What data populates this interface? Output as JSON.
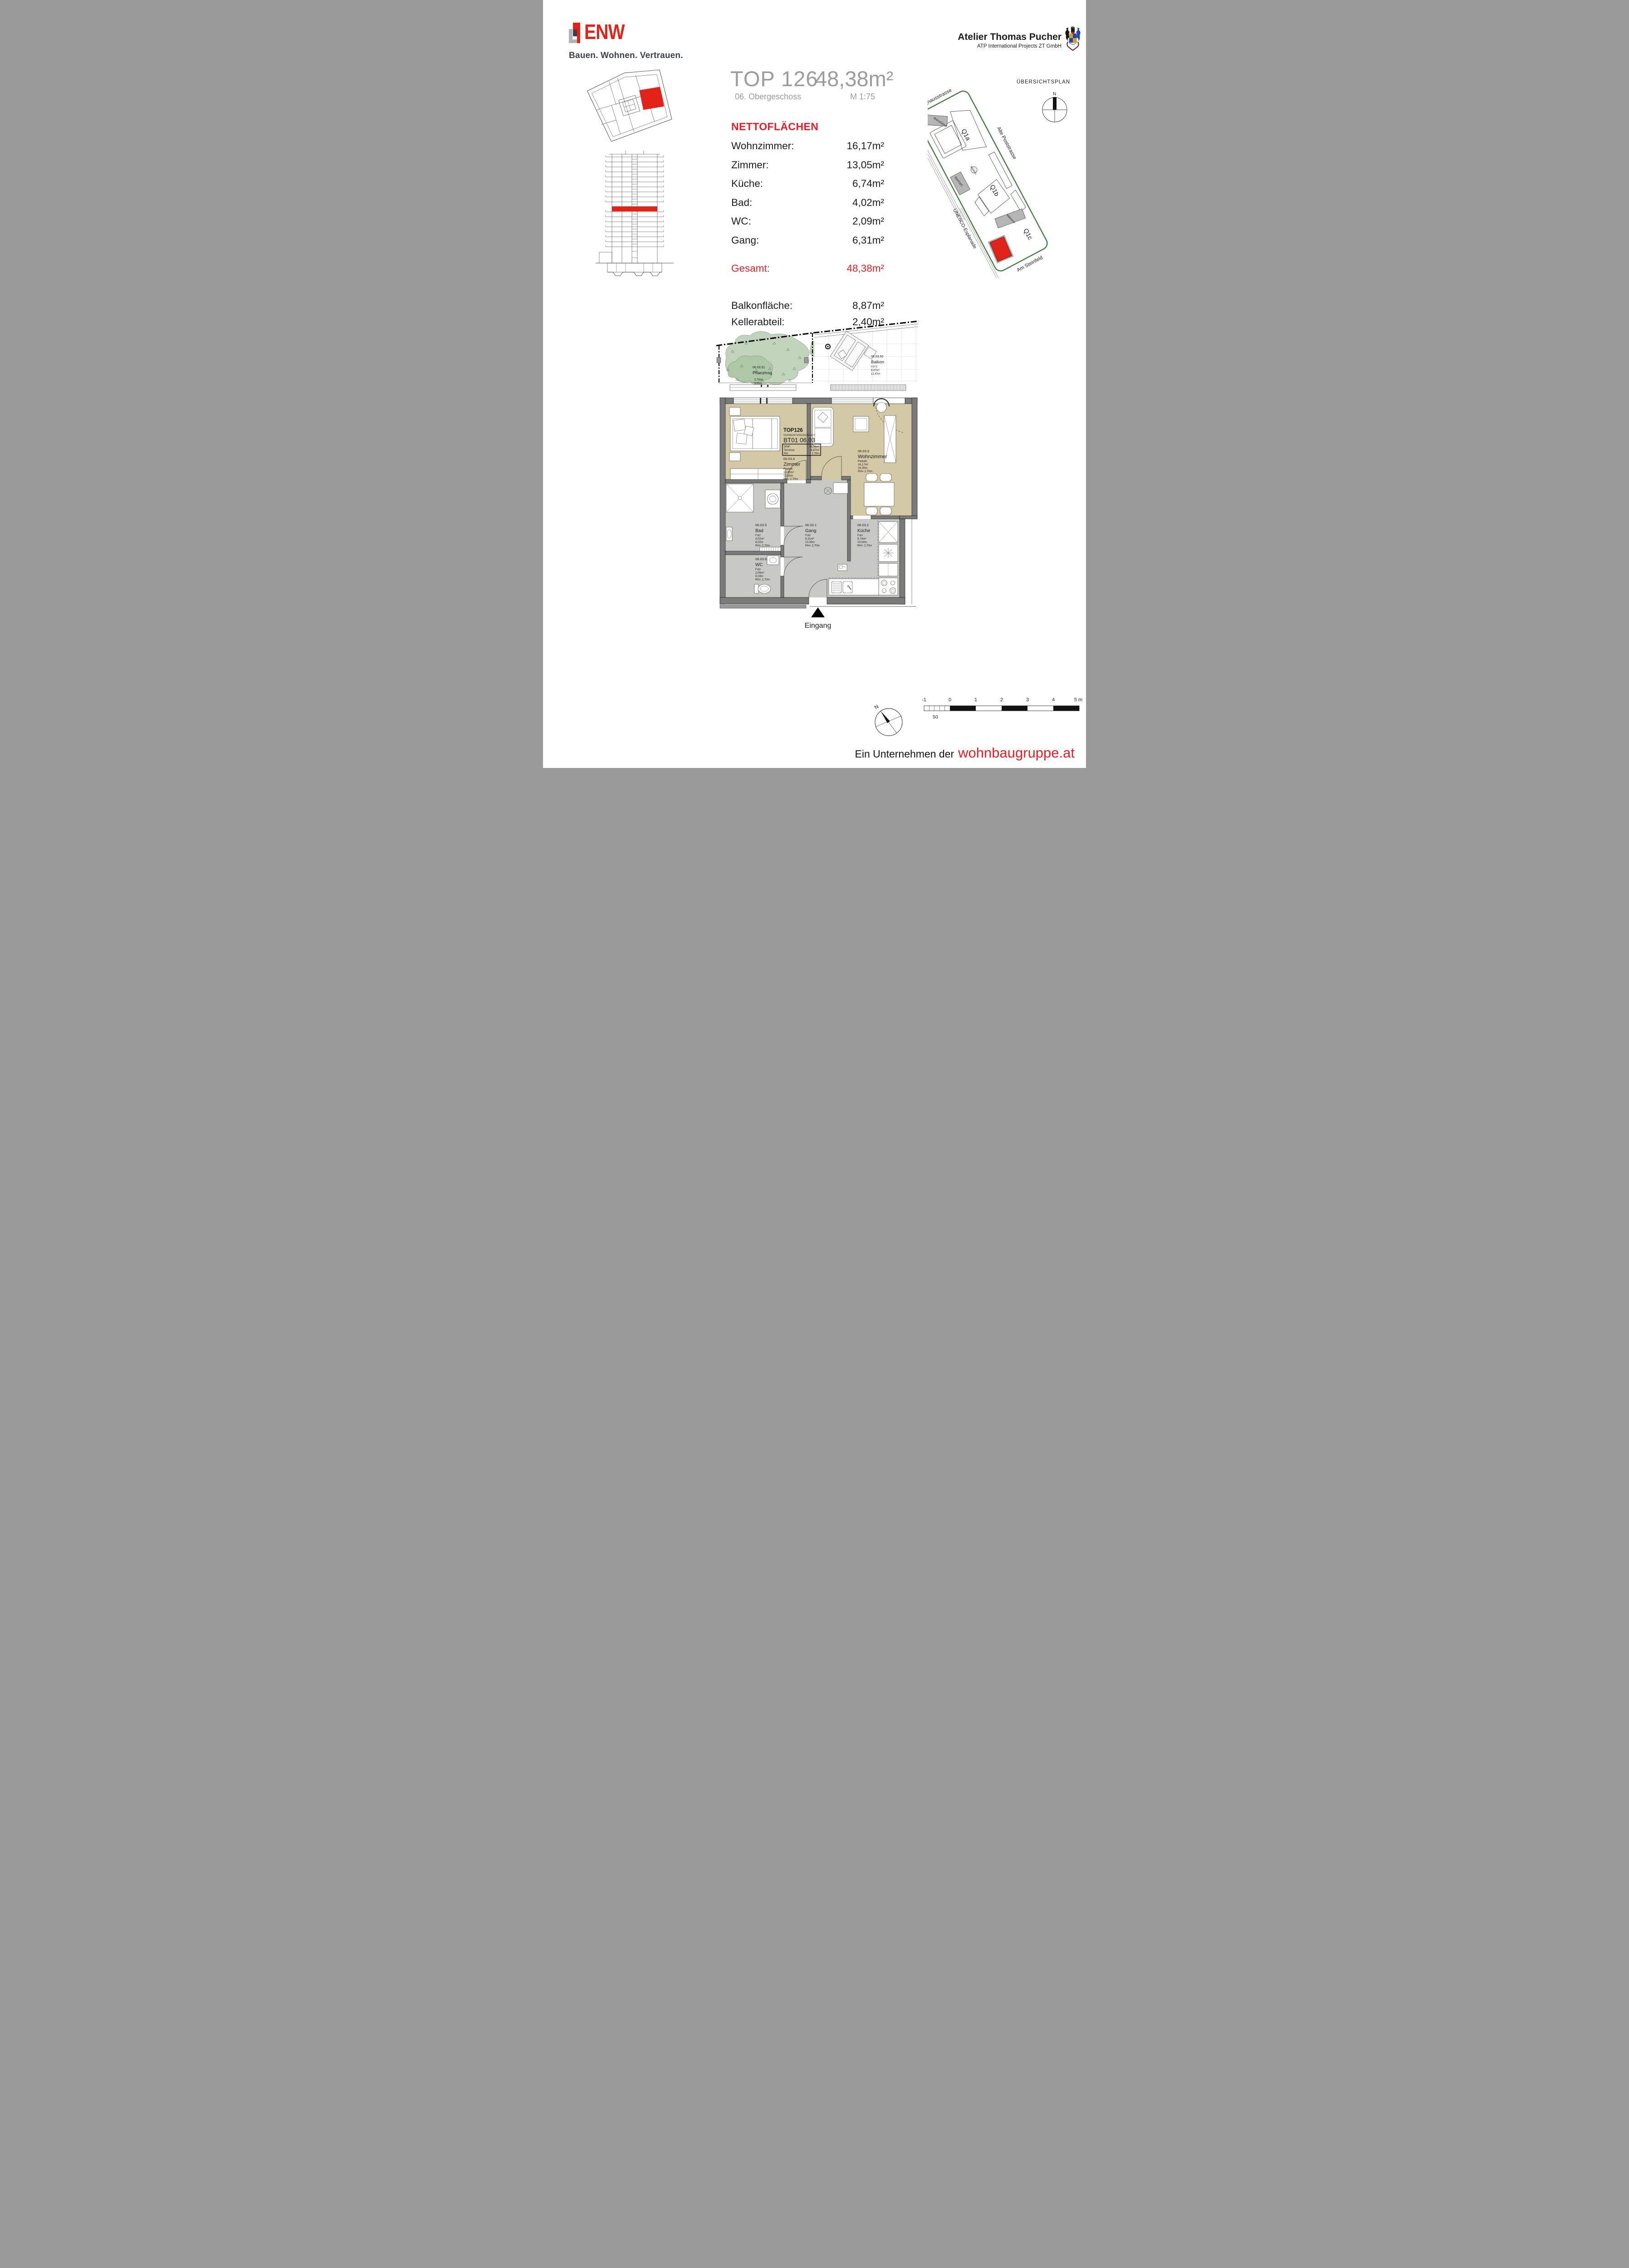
{
  "header": {
    "logo_name": "ENW",
    "logo_tagline": "Bauen. Wohnen. Vertrauen.",
    "architect_name": "Atelier Thomas Pucher",
    "architect_subtitle": "ATP International Projects ZT GmbH"
  },
  "title": {
    "unit": "TOP 126",
    "floor": "06. Obergeschoss",
    "area": "48,38m²",
    "scale": "M 1:75"
  },
  "areas": {
    "heading": "NETTOFLÄCHEN",
    "rows": [
      {
        "label": "Wohnzimmer:",
        "value": "16,17m²"
      },
      {
        "label": "Zimmer:",
        "value": "13,05m²"
      },
      {
        "label": "Küche:",
        "value": "6,74m²"
      },
      {
        "label": "Bad:",
        "value": "4,02m²"
      },
      {
        "label": "WC:",
        "value": "2,09m²"
      },
      {
        "label": "Gang:",
        "value": "6,31m²"
      }
    ],
    "total": {
      "label": "Gesamt:",
      "value": "48,38m²"
    },
    "extra": [
      {
        "label": "Balkonfläche:",
        "value": "8,87m²"
      },
      {
        "label": "Kellerabteil:",
        "value": "2,40m²"
      }
    ]
  },
  "site_plan": {
    "title": "ÜBERSICHTSPLAN",
    "north": "N",
    "streets": [
      "Reininghausstrasse",
      "Strassenbahn",
      "UNESCO-Esplanade",
      "Alte Poststrasse",
      "Am Steinfeld"
    ],
    "quarters": [
      "Q1a",
      "Q1b",
      "Q1c"
    ],
    "places": [
      "Bräustüberl",
      "Brunnen",
      "StartUpC.",
      "Mälzerei"
    ]
  },
  "floor_plan": {
    "unit_block": {
      "name": "TOP126",
      "type": "VERWERTUNGSEINHEIT",
      "code": "BT01 06.03",
      "wnf_label": "WNF:",
      "wnf": "48,38m²",
      "terrasse_label": "Terrasse:",
      "terrasse": "8,87m²",
      "rh_label": "RH:",
      "rh": "2,70m"
    },
    "rooms": [
      {
        "id": "06.03.4",
        "name": "Zimmer",
        "floor": "Parkett",
        "area": "13,05m²",
        "perimeter": "15,43m",
        "height": "RH= 2,70m"
      },
      {
        "id": "06.03.3",
        "name": "Wohnzimmer",
        "floor": "Parkett",
        "area": "16,17m²",
        "perimeter": "16,35m",
        "height": "RH= 2,70m"
      },
      {
        "id": "06.03.5",
        "name": "Bad",
        "floor": "Fstz",
        "area": "4,02m²",
        "perimeter": "8,02m",
        "height": "RH= 2,70m"
      },
      {
        "id": "06.03.6",
        "name": "WC",
        "floor": "Fstz",
        "area": "2,09m²",
        "perimeter": "6,04m",
        "height": "RH= 2,70m"
      },
      {
        "id": "06.03.1",
        "name": "Gang",
        "floor": "Fstz",
        "area": "6,31m²",
        "perimeter": "10,39m",
        "height": "RH= 2,70m"
      },
      {
        "id": "06.03.2",
        "name": "Küche",
        "floor": "Fstz",
        "area": "6,74m²",
        "perimeter": "10,54m",
        "height": "RH= 2,70m"
      },
      {
        "id": "06.03.50",
        "name": "Balkon",
        "floor": "FSTZ",
        "area": "8,87m²",
        "perimeter": "12,47m"
      },
      {
        "id": "06.03.51",
        "name": "Pflanztrog",
        "area": "5,79m²",
        "perimeter": "9,65m"
      }
    ],
    "entrance": "Eingang"
  },
  "scale_bar": {
    "labels": [
      "-1",
      "0",
      "1",
      "2",
      "3",
      "4",
      "5 m"
    ],
    "sub": "50"
  },
  "footer": {
    "prefix": "Ein Unternehmen der",
    "brand": "wohnbaugruppe.at"
  },
  "colors": {
    "brand_red": "#e2231a",
    "accent_red": "#ed1c24",
    "title_gray": "#9c9c9c",
    "wall": "#7a7a7a",
    "parquet": "#d3c9a6",
    "tile": "#c8c8c4",
    "site_green": "#3e7d3e"
  }
}
